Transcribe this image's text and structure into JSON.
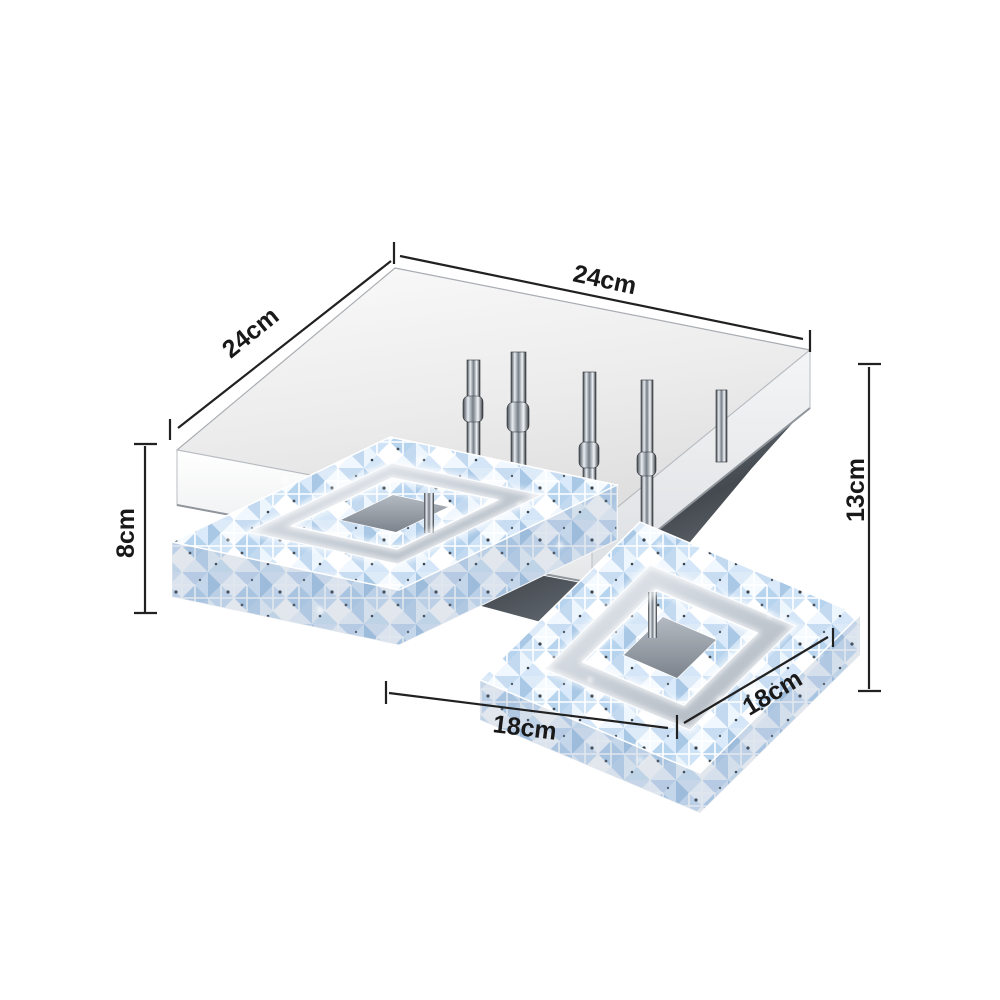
{
  "diagram": {
    "description": "Square crystal LED flush-mount ceiling lamp with dimension annotations",
    "annotation_color": "#212121",
    "background_color": "#ffffff",
    "dimensions": {
      "base_width": "24cm",
      "base_depth": "24cm",
      "total_height": "13cm",
      "body_height": "8cm",
      "ring_width": "18cm",
      "ring_depth": "18cm"
    }
  }
}
